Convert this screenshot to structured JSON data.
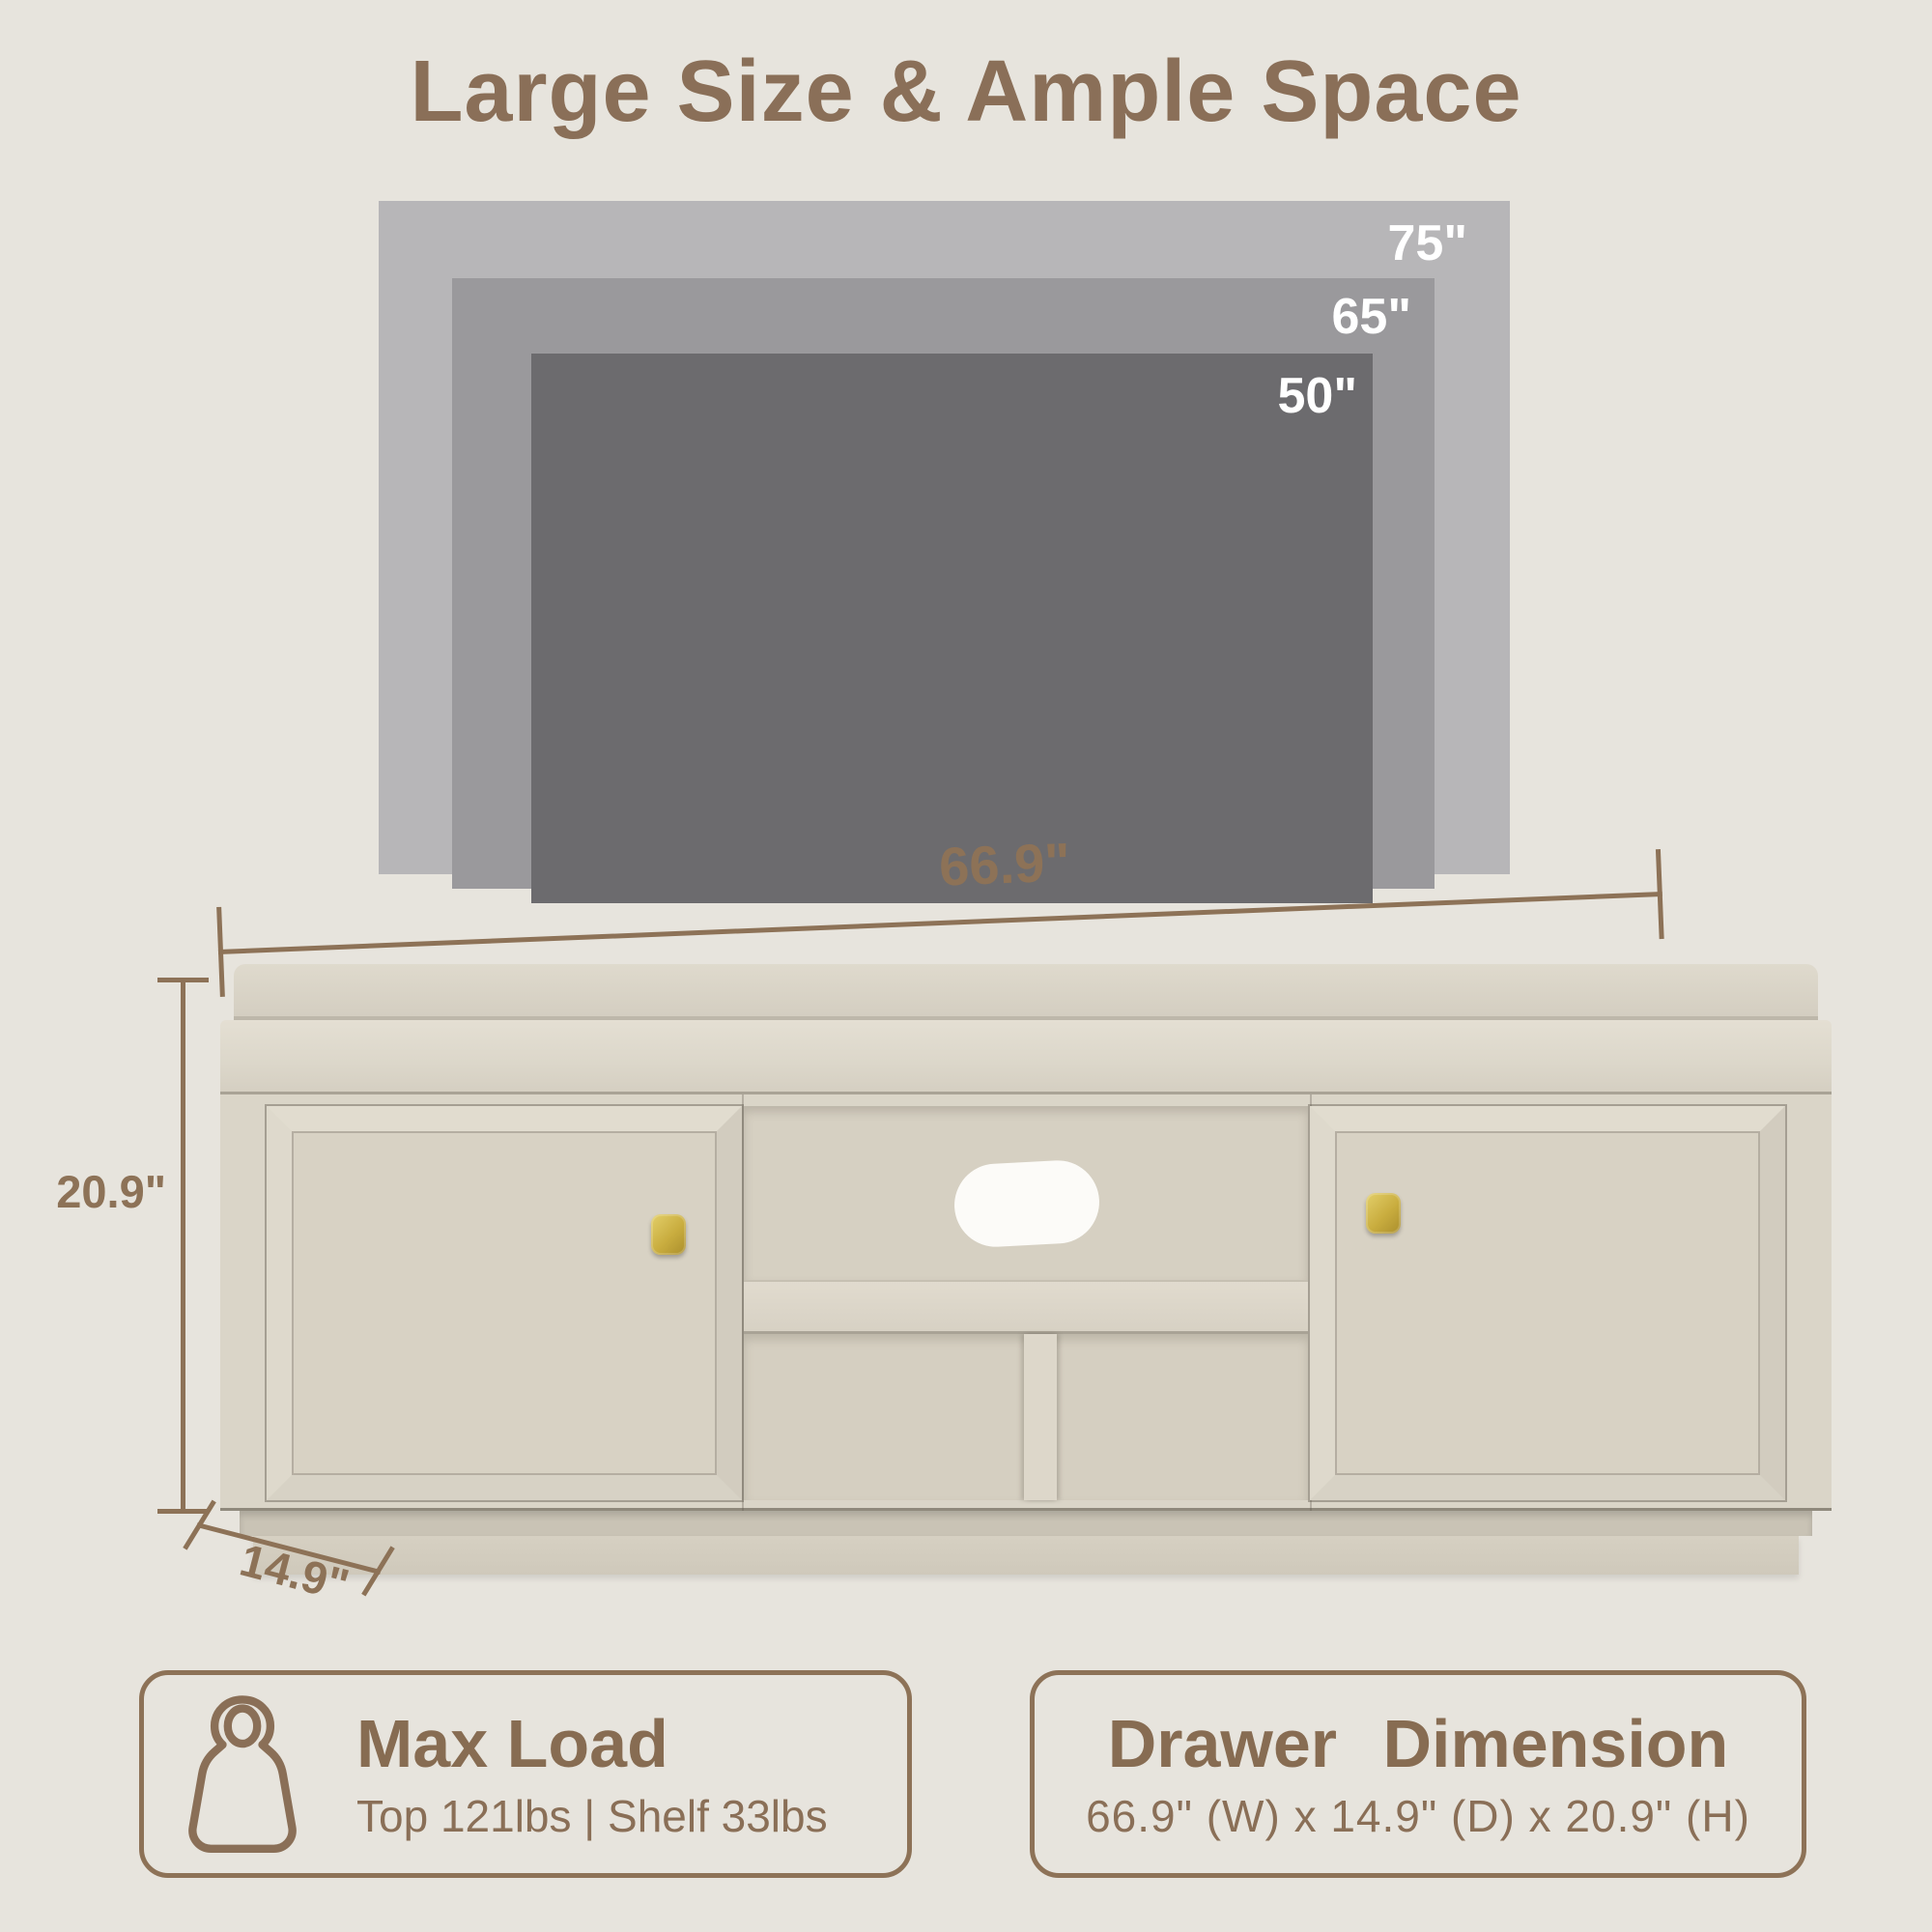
{
  "title": "Large Size & Ample Space",
  "tv_sizes": [
    {
      "name": "75-inch",
      "label": "75\""
    },
    {
      "name": "65-inch",
      "label": "65\""
    },
    {
      "name": "50-inch",
      "label": "50\""
    }
  ],
  "stand_dimensions": {
    "width_label": "66.9\"",
    "height_label": "20.9\"",
    "depth_label": "14.9\""
  },
  "info_cards": [
    {
      "icon": "weight-icon",
      "title": "Max Load",
      "detail": "Top 121lbs | Shelf 33lbs"
    },
    {
      "title": "Drawer Dimension",
      "detail": "66.9\" (W) x 14.9\" (D) x 20.9\" (H)"
    }
  ],
  "colors": {
    "background": "#e7e4dd",
    "accent_brown": "#8d7257",
    "title_brown": "#8a6f58",
    "tv_75_gray": "#b7b6b8",
    "tv_65_gray": "#9a999c",
    "tv_50_gray": "#6c6b6e",
    "tv_label_white": "#ffffff",
    "wood_light": "#dad5c8",
    "knob_gold": "#c8ad45",
    "cable_hole_white": "#fcfbf8"
  }
}
